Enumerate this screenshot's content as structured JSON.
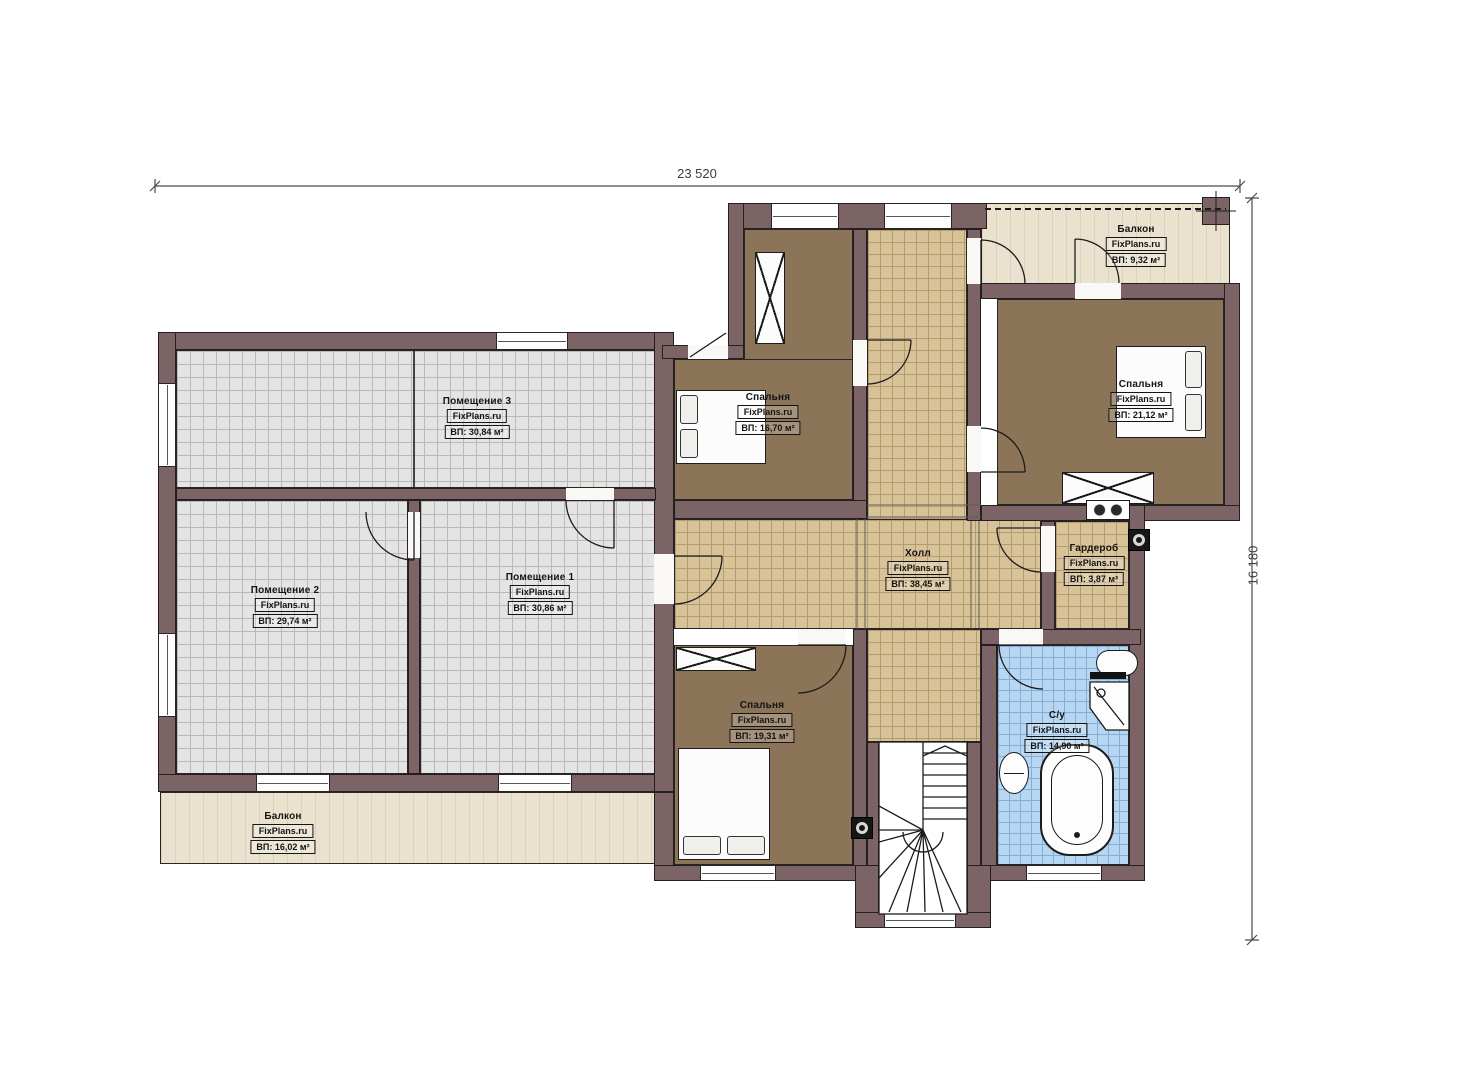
{
  "brand": "FixPlans.ru",
  "dimensions": {
    "width_label": "23 520",
    "height_label": "16 180"
  },
  "rooms": {
    "room3": {
      "name": "Помещение 3",
      "area": "ВП: 30,84 м²"
    },
    "room2": {
      "name": "Помещение 2",
      "area": "ВП: 29,74 м²"
    },
    "room1": {
      "name": "Помещение 1",
      "area": "ВП: 30,86 м²"
    },
    "bedroom_top": {
      "name": "Спальня",
      "area": "ВП: 16,70 м²"
    },
    "bedroom_right": {
      "name": "Спальня",
      "area": "ВП: 21,12 м²"
    },
    "bedroom_bottom": {
      "name": "Спальня",
      "area": "ВП: 19,31 м²"
    },
    "hall": {
      "name": "Холл",
      "area": "ВП: 38,45 м²"
    },
    "wardrobe": {
      "name": "Гардероб",
      "area": "ВП: 3,87 м²"
    },
    "bathroom": {
      "name": "С/у",
      "area": "ВП: 14,90 м²"
    },
    "balcony_top": {
      "name": "Балкон",
      "area": "ВП: 9,32 м²"
    },
    "balcony_bottom": {
      "name": "Балкон",
      "area": "ВП: 16,02 м²"
    }
  },
  "colors": {
    "wall": "#7b6366",
    "floor_gray": "#e4e4e4",
    "floor_tan": "#d8c298",
    "floor_brown": "#8c7458",
    "floor_blue": "#b7d6f1",
    "balcony": "#eae2ce"
  }
}
